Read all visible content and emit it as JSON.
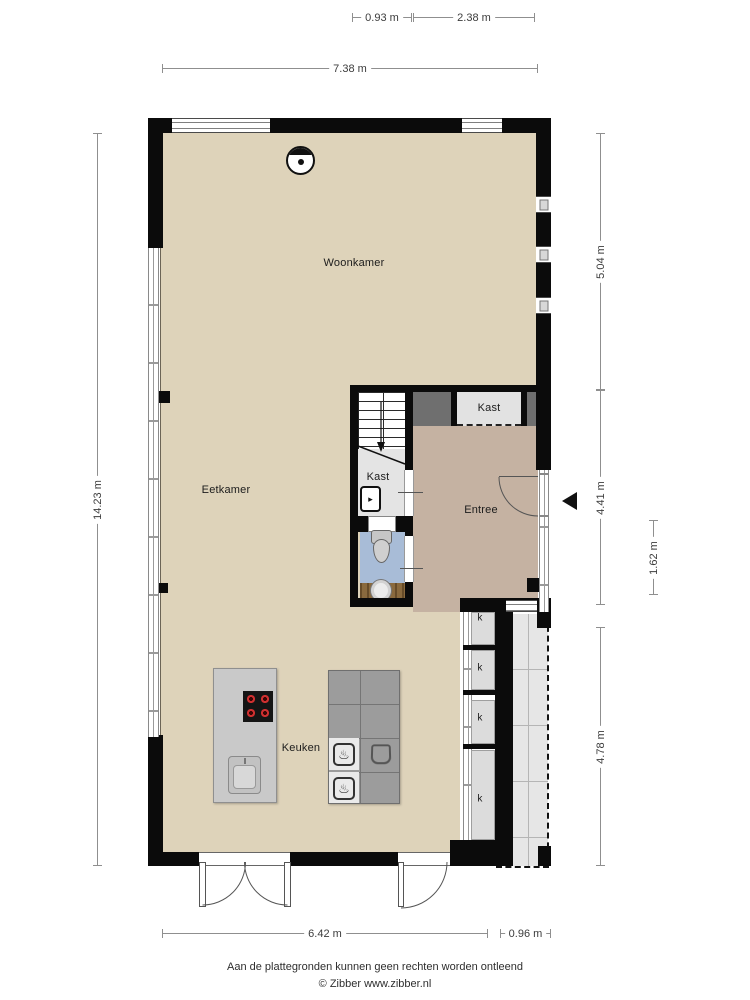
{
  "plan_title": "Begane grond plattegrond",
  "rooms": {
    "woonkamer": "Woonkamer",
    "eetkamer": "Eetkamer",
    "keuken": "Keuken",
    "entree": "Entree",
    "kast_upper": "Kast",
    "kast_stairs": "Kast"
  },
  "cupboards": [
    "k",
    "k",
    "k",
    "k"
  ],
  "dimensions": {
    "top_left": "0.93 m",
    "top_right": "2.38 m",
    "top_total": "7.38 m",
    "left_total": "14.23 m",
    "right_upper": "5.04 m",
    "right_middle": "4.41 m",
    "right_inner": "1.62 m",
    "right_lower": "4.78 m",
    "bottom_main": "6.42 m",
    "bottom_right": "0.96 m"
  },
  "footer": {
    "disclaimer": "Aan de plattegronden kunnen geen rechten worden ontleend",
    "credit": "© Zibber www.zibber.nl"
  },
  "colors": {
    "floor_beige": "#ded3ba",
    "floor_entree": "#c5b2a2",
    "toilet_blue": "#a8bcd7",
    "vanity_wood": "#8a6a3e",
    "wall_black": "#0b0b0b",
    "closet_light": "#e2e2e2",
    "niche_dark": "#6f6f6f",
    "island_gray": "#c9c9c9",
    "counter_gray": "#9c9c9c",
    "tile_gray": "#e6e6e6"
  }
}
